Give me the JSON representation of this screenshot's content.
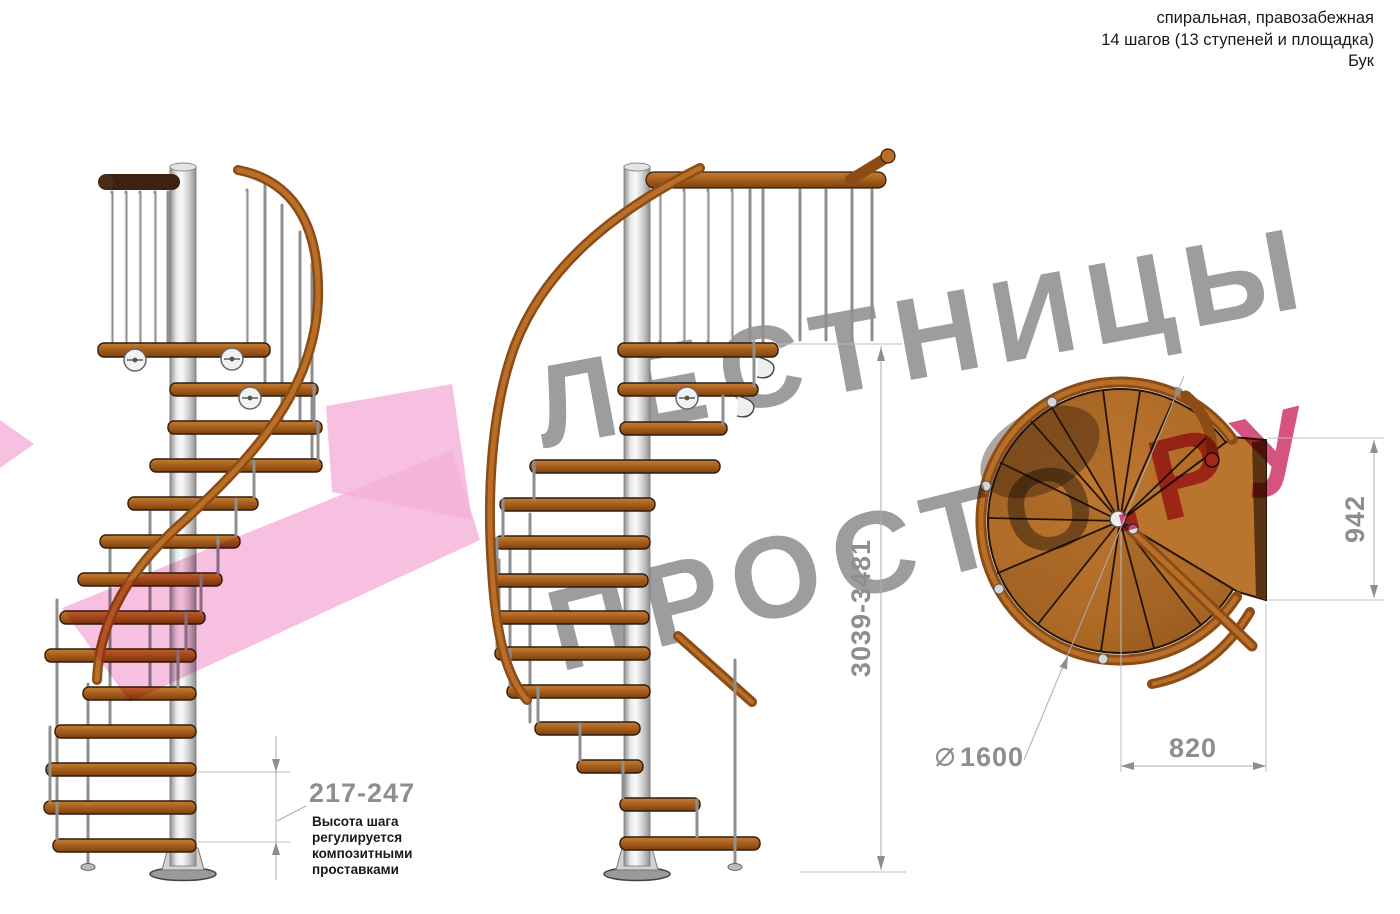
{
  "header": {
    "lines": [
      "спиральная, правозабежная",
      "14 шагов (13 ступеней и площадка)",
      "Бук"
    ]
  },
  "watermark": {
    "line1": "ЛЕСТНИЦЫ",
    "line2_gray": "ПРОСТО",
    "line2_pink": ".РУ",
    "gray_color": "#9d9d9d",
    "pink_text_color": "#d6527f",
    "arrow_color": "#f6b4da"
  },
  "dimensions": {
    "total_height": "3039-3481",
    "step_height": "217-247",
    "step_note_lines": [
      "Высота шага",
      "регулируется",
      "композитными",
      "проставками"
    ],
    "landing_depth": "942",
    "diameter_symbol": "⌀",
    "diameter": "1600",
    "landing_width": "820"
  },
  "materials": {
    "wood_light": "#c67f35",
    "wood_mid": "#a9601c",
    "wood_dark": "#7c420f",
    "metal_light": "#fbfbfb",
    "metal_dark": "#8f8f8f"
  },
  "views": {
    "front": "front-elevation-view",
    "side": "side-elevation-view",
    "plan": "top-plan-view"
  }
}
